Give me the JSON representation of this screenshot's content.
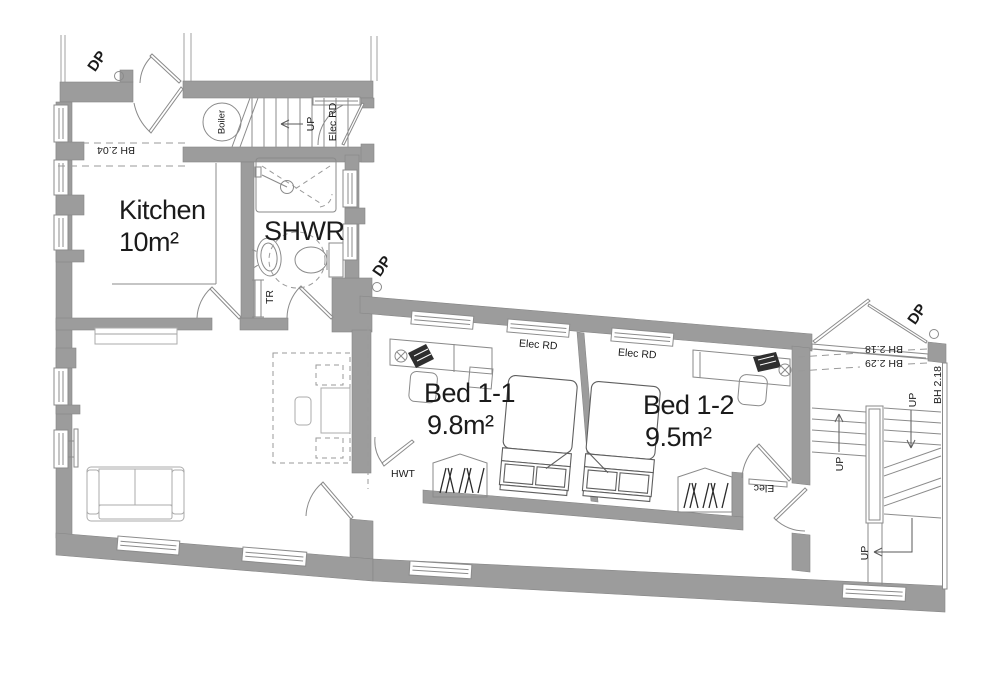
{
  "drawing_type": "floor-plan",
  "rooms": {
    "kitchen": {
      "name": "Kitchen",
      "area": "10m²"
    },
    "shower": {
      "name": "SHWR"
    },
    "bed11": {
      "name": "Bed 1-1",
      "area": "9.8m²"
    },
    "bed12": {
      "name": "Bed 1-2",
      "area": "9.5m²"
    }
  },
  "labels": {
    "boiler": "Boiler",
    "up_top_stair": "UP",
    "up_flight_left": "UP",
    "up_flight_right": "UP",
    "up_bottom": "UP",
    "elec_rd_stair": "Elec RD",
    "elec_rd_bed11": "Elec RD",
    "elec_rd_bed12": "Elec RD",
    "dp_top_left": "DP",
    "dp_middle": "DP",
    "dp_top_right": "DP",
    "bh_kitchen": "BH 2.04",
    "bh_landing_upper": "BH 2.18",
    "bh_landing_lower": "BH 2.29",
    "bh_right_wall": "BH 2.18",
    "hwt": "HWT",
    "tr": "TR",
    "elec_panel": "Elec"
  },
  "colors": {
    "wall": "#9c9c9c",
    "line": "#8b8b8b",
    "furniture": "#ababab",
    "text": "#1b1b1b",
    "dark": "#2f2f2f"
  }
}
